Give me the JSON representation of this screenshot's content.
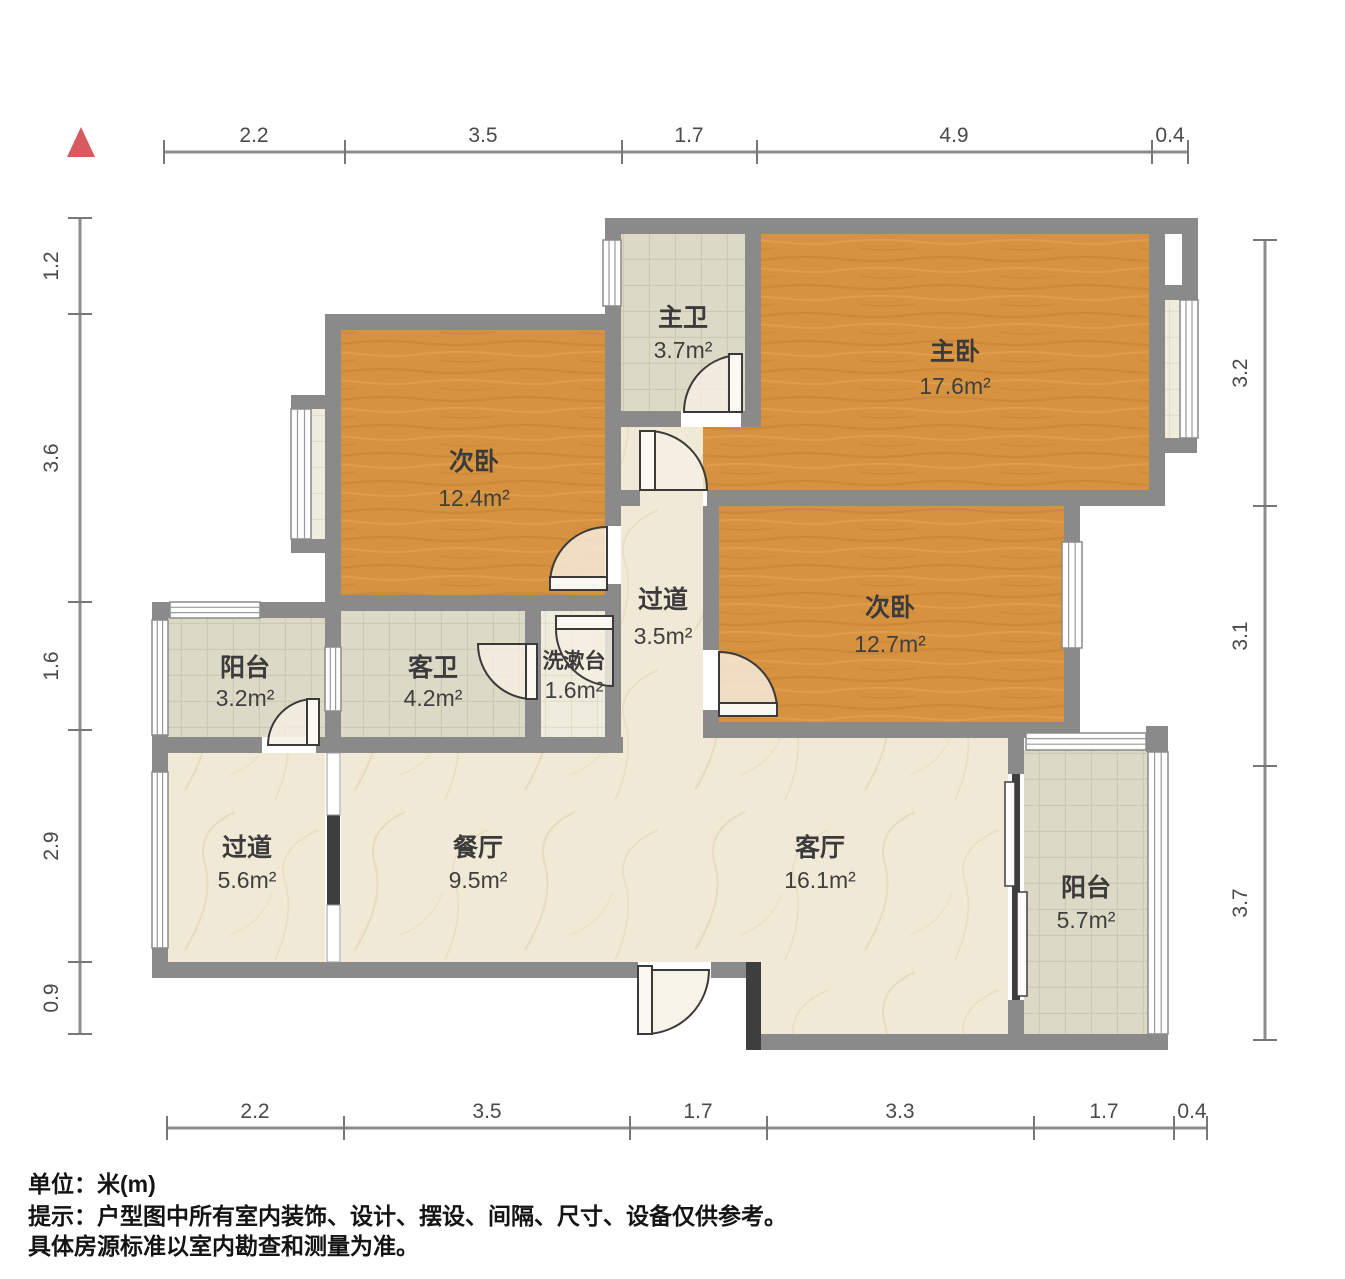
{
  "meta": {
    "type": "apartment-floor-plan"
  },
  "north_indicator": {
    "icon": "north-arrow",
    "color": "#D65A5E"
  },
  "colors": {
    "wall": "#8A8A8A",
    "partition_dark": "#3E3E3E",
    "wood_floor": "#D6923F",
    "marble_floor": "#F0E9D6",
    "tile_floor": "#DCDAC6",
    "cream_floor": "#F0ECDD",
    "ruler": "#8C8C8C",
    "label_text": "#3B3B3B"
  },
  "rulers": {
    "unit": "m",
    "top": {
      "labels": [
        "2.2",
        "3.5",
        "1.7",
        "4.9",
        "0.4"
      ]
    },
    "bottom": {
      "labels": [
        "2.2",
        "3.5",
        "1.7",
        "3.3",
        "1.7",
        "0.4"
      ]
    },
    "left": {
      "labels": [
        "1.2",
        "3.6",
        "1.6",
        "2.9",
        "0.9"
      ]
    },
    "right": {
      "labels": [
        "3.2",
        "3.1",
        "3.7"
      ]
    }
  },
  "rooms": {
    "master_bath": {
      "name": "主卫",
      "area": "3.7m²"
    },
    "master_bedroom": {
      "name": "主卧",
      "area": "17.6m²"
    },
    "bedroom_left": {
      "name": "次卧",
      "area": "12.4m²"
    },
    "hallway_center": {
      "name": "过道",
      "area": "3.5m²"
    },
    "bedroom_right": {
      "name": "次卧",
      "area": "12.7m²"
    },
    "balcony_left": {
      "name": "阳台",
      "area": "3.2m²"
    },
    "guest_bath": {
      "name": "客卫",
      "area": "4.2m²"
    },
    "washstand": {
      "name": "洗漱台",
      "area": "1.6m²"
    },
    "hallway_bottom": {
      "name": "过道",
      "area": "5.6m²"
    },
    "dining_room": {
      "name": "餐厅",
      "area": "9.5m²"
    },
    "living_room": {
      "name": "客厅",
      "area": "16.1m²"
    },
    "balcony_right": {
      "name": "阳台",
      "area": "5.7m²"
    }
  },
  "notes": {
    "unit_note": "单位：米(m)",
    "disclaimer_line1": "提示：户型图中所有室内装饰、设计、摆设、间隔、尺寸、设备仅供参考。",
    "disclaimer_line2": "具体房源标准以室内勘查和测量为准。"
  }
}
